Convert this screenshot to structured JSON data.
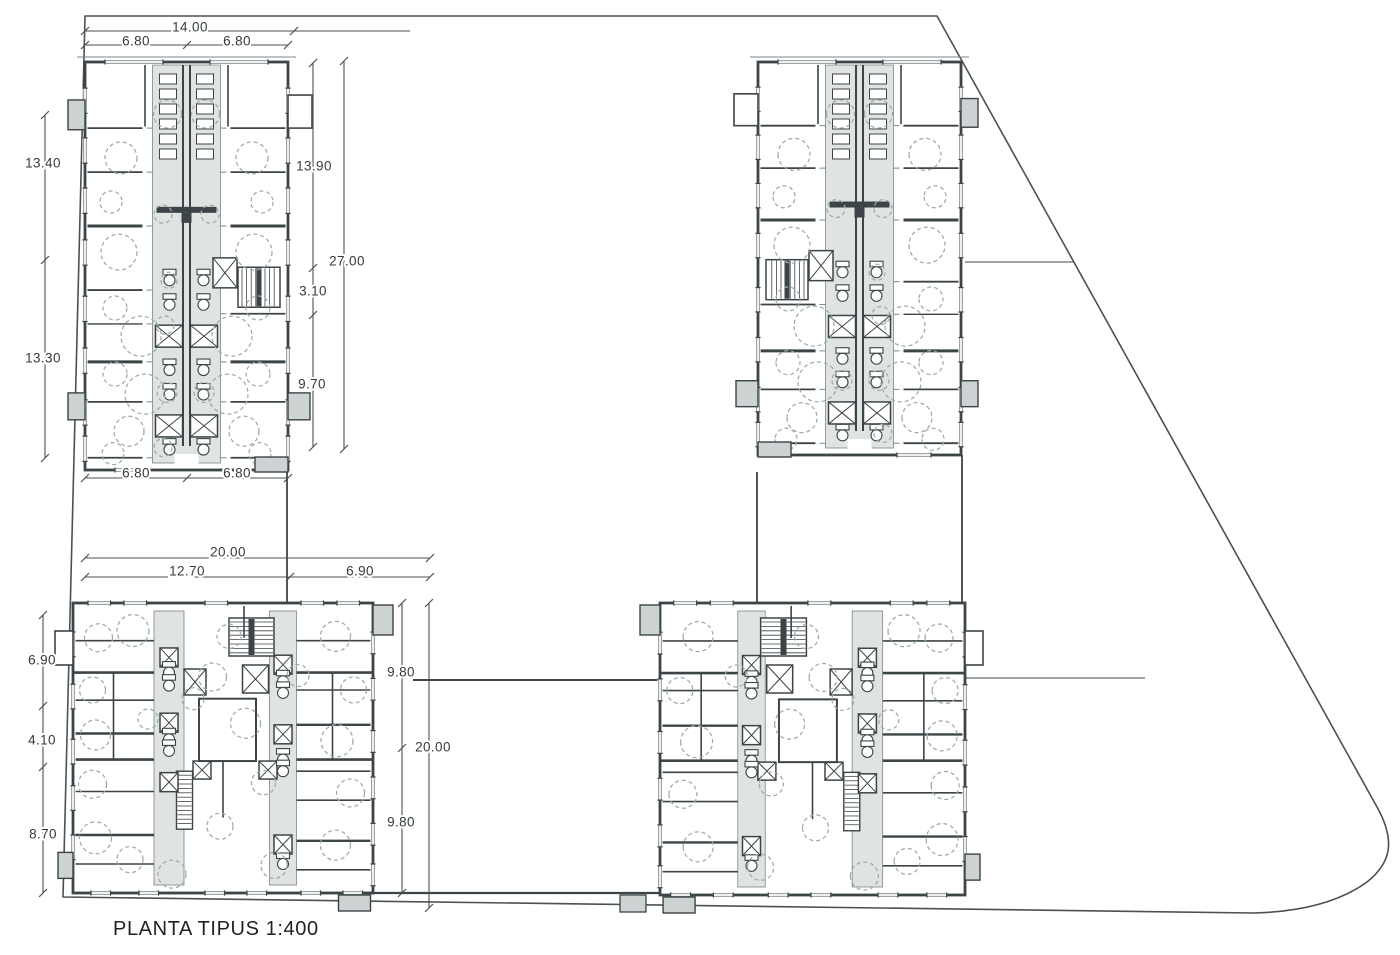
{
  "title": {
    "text": "PLANTA TIPUS 1:400"
  },
  "colors": {
    "wall": "#3d4447",
    "thin": "#7d8689",
    "boundary": "#4a5156",
    "core_fill": "#dfe3e2",
    "balcony_fill": "#ccd3d2",
    "dash": "#9fa9ab",
    "dim_line": "#4a5156",
    "dim_text": "#343b3e",
    "paper": "#ffffff"
  },
  "boundary": {
    "path": "M85,16 L937,16 L1377,807 C1396,841 1391,863 1367,882 C1338,903 1297,912 1253,913 L63,897 Z"
  },
  "connectors": [
    {
      "x1": 287,
      "y1": 472,
      "x2": 287,
      "y2": 603,
      "sw": 1.8
    },
    {
      "x1": 757,
      "y1": 472,
      "x2": 757,
      "y2": 603,
      "sw": 1.8
    },
    {
      "x1": 962,
      "y1": 455,
      "x2": 962,
      "y2": 603,
      "sw": 1.8
    },
    {
      "x1": 965,
      "y1": 262,
      "x2": 1073,
      "y2": 262,
      "sw": 1.1
    },
    {
      "x1": 413,
      "y1": 680,
      "x2": 660,
      "y2": 680,
      "sw": 2.0
    },
    {
      "x1": 965,
      "y1": 678,
      "x2": 1145,
      "y2": 678,
      "sw": 1.1
    },
    {
      "x1": 373,
      "y1": 893,
      "x2": 660,
      "y2": 893,
      "sw": 2.2
    }
  ],
  "site_features": [
    {
      "type": "balcony",
      "x": 620,
      "y": 895,
      "w": 26,
      "h": 17
    }
  ],
  "blocks": [
    {
      "id": "tower-nw",
      "type": "tower",
      "x": 85,
      "y": 62,
      "w": 203,
      "h": 408,
      "mirror": false
    },
    {
      "id": "tower-ne",
      "type": "tower",
      "x": 758,
      "y": 62,
      "w": 203,
      "h": 393,
      "mirror": true
    },
    {
      "id": "slab-sw",
      "type": "slab",
      "x": 73,
      "y": 603,
      "w": 300,
      "h": 290,
      "mirror": false
    },
    {
      "id": "slab-se",
      "type": "slab",
      "x": 660,
      "y": 603,
      "w": 305,
      "h": 292,
      "mirror": true
    }
  ],
  "dimensions": [
    {
      "id": "top-total",
      "orient": "h",
      "pos": 31,
      "from": 85,
      "to": 410,
      "ticks": [
        85,
        294
      ],
      "labels": [
        {
          "text": "14.00",
          "x": 190,
          "y": 27
        }
      ]
    },
    {
      "id": "top-halves",
      "orient": "h",
      "pos": 45,
      "from": 85,
      "to": 288,
      "ticks": [
        85,
        187,
        288
      ],
      "labels": [
        {
          "text": "6.80",
          "x": 136,
          "y": 41
        },
        {
          "text": "6.80",
          "x": 237,
          "y": 41
        }
      ]
    },
    {
      "id": "west-tower",
      "orient": "v",
      "pos": 45,
      "from": 115,
      "to": 458,
      "ticks": [
        115,
        260,
        458
      ],
      "labels": [
        {
          "text": "13.40",
          "x": 43,
          "y": 163
        },
        {
          "text": "13.30",
          "x": 43,
          "y": 358
        }
      ]
    },
    {
      "id": "east-tower-parts",
      "orient": "v",
      "pos": 313,
      "from": 63,
      "to": 447,
      "ticks": [
        63,
        268,
        315,
        447
      ],
      "labels": [
        {
          "text": "13.90",
          "x": 314,
          "y": 166
        },
        {
          "text": "3.10",
          "x": 313,
          "y": 291
        },
        {
          "text": "9.70",
          "x": 312,
          "y": 384
        }
      ]
    },
    {
      "id": "east-tower-total",
      "orient": "v",
      "pos": 344,
      "from": 61,
      "to": 449,
      "ticks": [
        61,
        449
      ],
      "labels": [
        {
          "text": "27.00",
          "x": 347,
          "y": 261
        }
      ]
    },
    {
      "id": "below-tower",
      "orient": "h",
      "pos": 478,
      "from": 85,
      "to": 288,
      "ticks": [
        85,
        187,
        288
      ],
      "labels": [
        {
          "text": "6.80",
          "x": 136,
          "y": 473
        },
        {
          "text": "6.80",
          "x": 237,
          "y": 473
        }
      ]
    },
    {
      "id": "slab-width-total",
      "orient": "h",
      "pos": 558,
      "from": 85,
      "to": 430,
      "ticks": [
        85,
        430
      ],
      "labels": [
        {
          "text": "20.00",
          "x": 228,
          "y": 552
        }
      ]
    },
    {
      "id": "slab-width-parts",
      "orient": "h",
      "pos": 577,
      "from": 85,
      "to": 430,
      "ticks": [
        85,
        290,
        430
      ],
      "labels": [
        {
          "text": "12.70",
          "x": 187,
          "y": 571
        },
        {
          "text": "6.90",
          "x": 360,
          "y": 571
        }
      ]
    },
    {
      "id": "west-slab",
      "orient": "v",
      "pos": 43,
      "from": 615,
      "to": 893,
      "ticks": [
        615,
        706,
        767,
        893
      ],
      "labels": [
        {
          "text": "6.90",
          "x": 42,
          "y": 660
        },
        {
          "text": "4.10",
          "x": 42,
          "y": 740
        },
        {
          "text": "8.70",
          "x": 43,
          "y": 834
        }
      ]
    },
    {
      "id": "mid-slab-parts",
      "orient": "v",
      "pos": 402,
      "from": 603,
      "to": 893,
      "ticks": [
        603,
        748,
        893
      ],
      "labels": [
        {
          "text": "9.80",
          "x": 401,
          "y": 672
        },
        {
          "text": "9.80",
          "x": 401,
          "y": 822
        }
      ]
    },
    {
      "id": "mid-slab-total",
      "orient": "v",
      "pos": 429,
      "from": 603,
      "to": 908,
      "ticks": [
        603,
        908
      ],
      "labels": [
        {
          "text": "20.00",
          "x": 433,
          "y": 747
        }
      ]
    }
  ]
}
